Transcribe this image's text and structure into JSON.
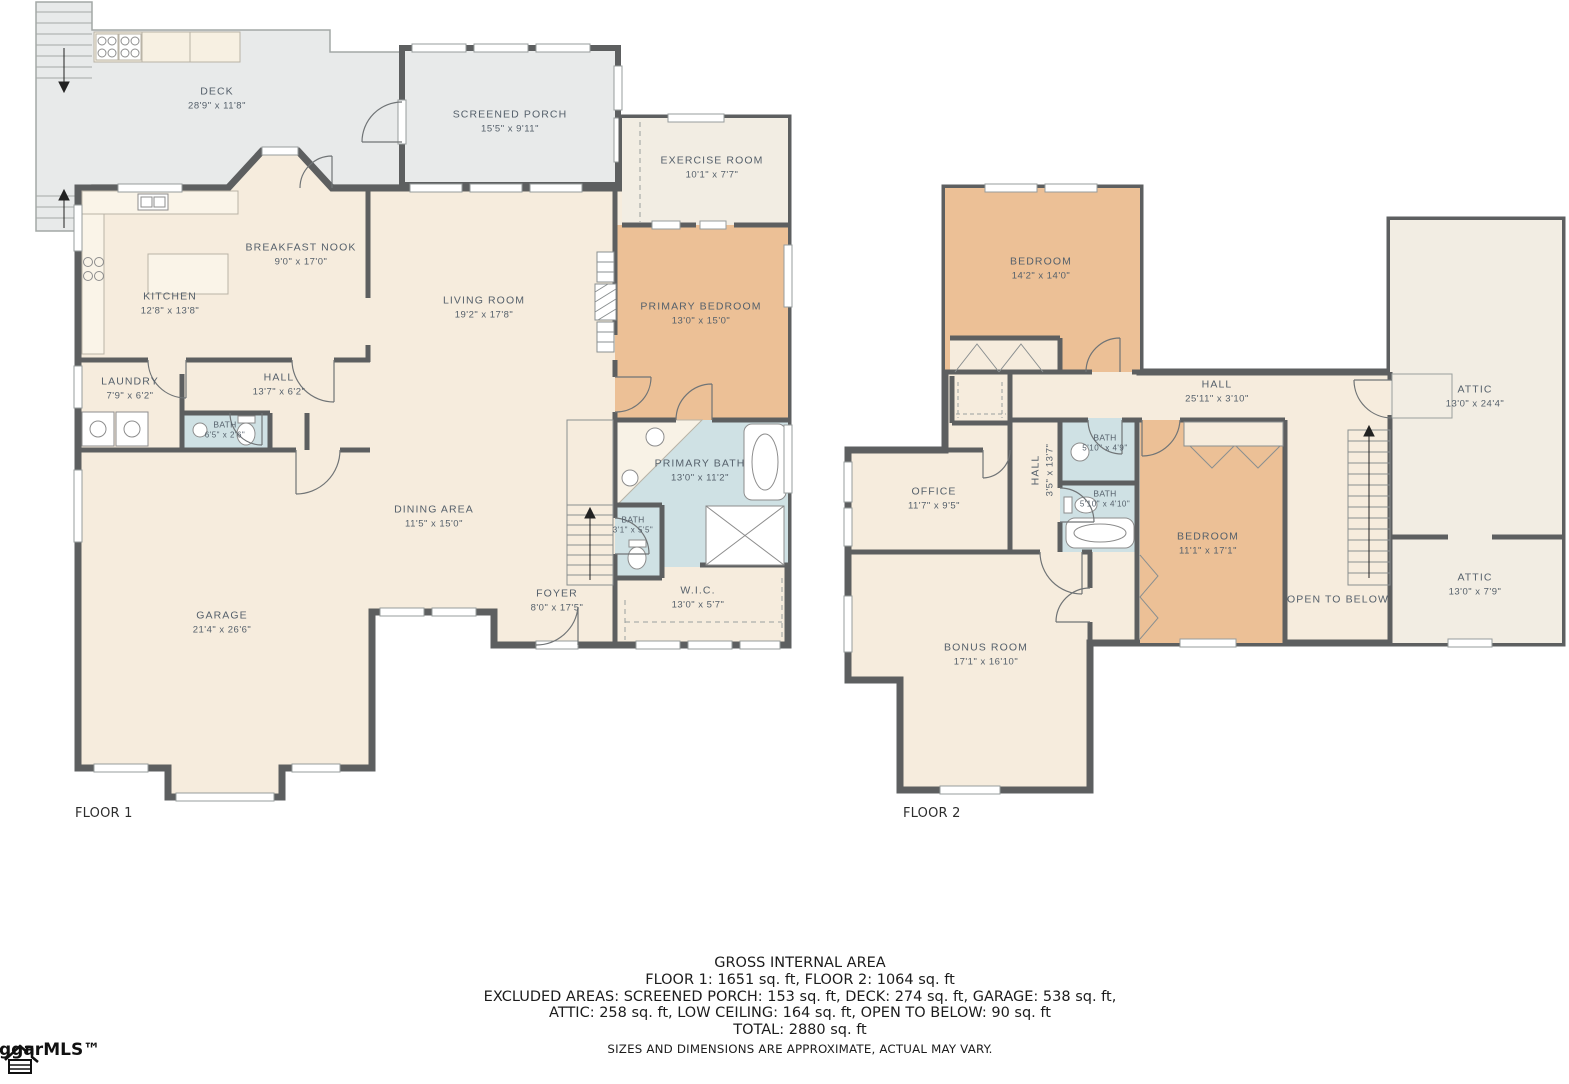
{
  "colors": {
    "wall": "#5D5F60",
    "room": "#F6ECDD",
    "roomLight": "#F2EDE3",
    "bedroomOrange": "#ECC096",
    "bathBlue": "#CFE1E4",
    "deckGray": "#E8EAEA",
    "label": "#55606B"
  },
  "floor1": {
    "label": "FLOOR 1",
    "rooms": {
      "deck": {
        "name": "DECK",
        "dims": "28'9\" x 11'8\""
      },
      "screened_porch": {
        "name": "SCREENED PORCH",
        "dims": "15'5\" x 9'11\""
      },
      "exercise_room": {
        "name": "EXERCISE ROOM",
        "dims": "10'1\" x 7'7\""
      },
      "breakfast_nook": {
        "name": "BREAKFAST NOOK",
        "dims": "9'0\" x 17'0\""
      },
      "kitchen": {
        "name": "KITCHEN",
        "dims": "12'8\" x 13'8\""
      },
      "living_room": {
        "name": "LIVING ROOM",
        "dims": "19'2\" x 17'8\""
      },
      "primary_bedroom": {
        "name": "PRIMARY BEDROOM",
        "dims": "13'0\" x 15'0\""
      },
      "laundry": {
        "name": "LAUNDRY",
        "dims": "7'9\" x 6'2\""
      },
      "hall": {
        "name": "HALL",
        "dims": "13'7\" x 6'2\""
      },
      "bath": {
        "name": "BATH",
        "dims": "6'5\" x 2'6\""
      },
      "garage": {
        "name": "GARAGE",
        "dims": "21'4\" x 26'6\""
      },
      "dining_area": {
        "name": "DINING AREA",
        "dims": "11'5\" x 15'0\""
      },
      "primary_bath": {
        "name": "PRIMARY BATH",
        "dims": "13'0\" x 11'2\""
      },
      "bath2": {
        "name": "BATH",
        "dims": "3'1\" x 5'5\""
      },
      "foyer": {
        "name": "FOYER",
        "dims": "8'0\" x 17'5\""
      },
      "wic": {
        "name": "W.I.C.",
        "dims": "13'0\" x 5'7\""
      }
    }
  },
  "floor2": {
    "label": "FLOOR 2",
    "rooms": {
      "bedroom1": {
        "name": "BEDROOM",
        "dims": "14'2\" x 14'0\""
      },
      "hall": {
        "name": "HALL",
        "dims": "25'11\" x 3'10\""
      },
      "attic1": {
        "name": "ATTIC",
        "dims": "13'0\" x 24'4\""
      },
      "hall_v": {
        "name": "HALL",
        "dims": "3'5\" x 13'7\""
      },
      "bath1": {
        "name": "BATH",
        "dims": "5'10\" x 4'9\""
      },
      "bath2": {
        "name": "BATH",
        "dims": "5'10\" x 4'10\""
      },
      "office": {
        "name": "OFFICE",
        "dims": "11'7\" x 9'5\""
      },
      "bedroom2": {
        "name": "BEDROOM",
        "dims": "11'1\" x 17'1\""
      },
      "open_to_below": {
        "name": "OPEN TO BELOW"
      },
      "attic2": {
        "name": "ATTIC",
        "dims": "13'0\" x 7'9\""
      },
      "bonus_room": {
        "name": "BONUS ROOM",
        "dims": "17'1\" x 16'10\""
      }
    }
  },
  "footer": {
    "line1": "GROSS INTERNAL AREA",
    "line2": "FLOOR 1: 1651 sq. ft, FLOOR 2: 1064 sq. ft",
    "line3": "EXCLUDED AREAS: SCREENED PORCH: 153 sq. ft, DECK: 274 sq. ft, GARAGE: 538 sq. ft,",
    "line4": "ATTIC: 258 sq. ft, LOW CEILING: 164 sq. ft, OPEN TO BELOW: 90 sq. ft",
    "line5": "TOTAL: 2880 sq. ft",
    "line6": "SIZES AND DIMENSIONS ARE APPROXIMATE, ACTUAL MAY VARY."
  },
  "logo": {
    "text": "ggarMLS™"
  }
}
